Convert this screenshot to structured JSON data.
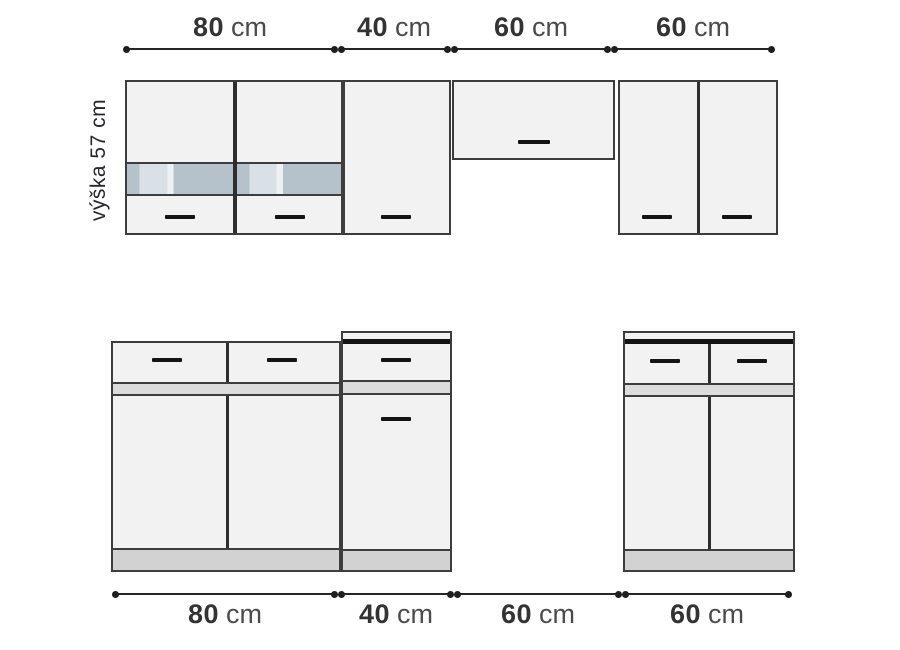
{
  "diagram": {
    "type": "kitchen-cabinet-dimension-drawing",
    "height_label": "výška 57 cm",
    "dimensions_top": [
      {
        "value": "80",
        "unit": "cm"
      },
      {
        "value": "40",
        "unit": "cm"
      },
      {
        "value": "60",
        "unit": "cm"
      },
      {
        "value": "60",
        "unit": "cm"
      }
    ],
    "dimensions_bottom": [
      {
        "value": "80",
        "unit": "cm"
      },
      {
        "value": "40",
        "unit": "cm"
      },
      {
        "value": "60",
        "unit": "cm"
      },
      {
        "value": "60",
        "unit": "cm"
      }
    ],
    "colors": {
      "outline": "#3d3d3d",
      "cabinet_fill": "#f2f2f2",
      "band_fill": "#dcdcdc",
      "plinth_fill": "#d2d2d2",
      "glass_dark": "#b6c2cb",
      "glass_light": "#d9e1e7",
      "glass_gap": "#eef1f3",
      "handle": "#141414",
      "dimension_text": "#333333"
    }
  }
}
